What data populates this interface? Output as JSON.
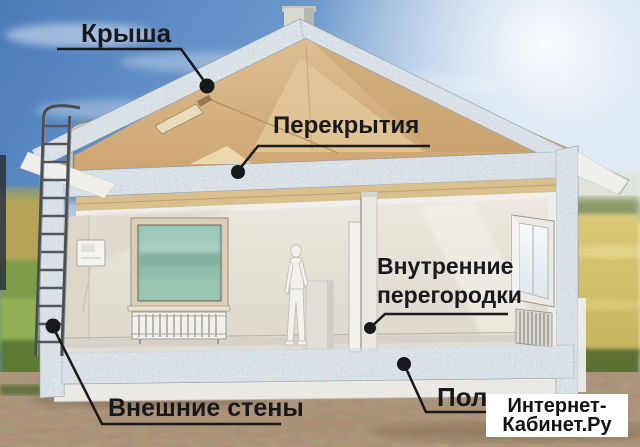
{
  "diagram": {
    "labels": {
      "roof": "Крыша",
      "ceilings": "Перекрытия",
      "partitions": [
        "Внутренние",
        "перегородки"
      ],
      "exterior_walls": "Внешние стены",
      "floor": "Пол"
    },
    "watermark": {
      "lines": [
        "Интернет-",
        "Кабинет.Ру"
      ]
    },
    "colors": {
      "label_text": "#17191d",
      "leader_line": "#17191d",
      "roof_gable_tan": "#d2ab78",
      "insulation_texture": "#b9c6d0",
      "sky_blue": "#4d7fbe",
      "ground_brown": "#8d7458",
      "grass_green": "#76973f",
      "field_yellow": "#cdbc6c",
      "watermark_bg": "#ffffff",
      "watermark_text": "#121212"
    }
  }
}
